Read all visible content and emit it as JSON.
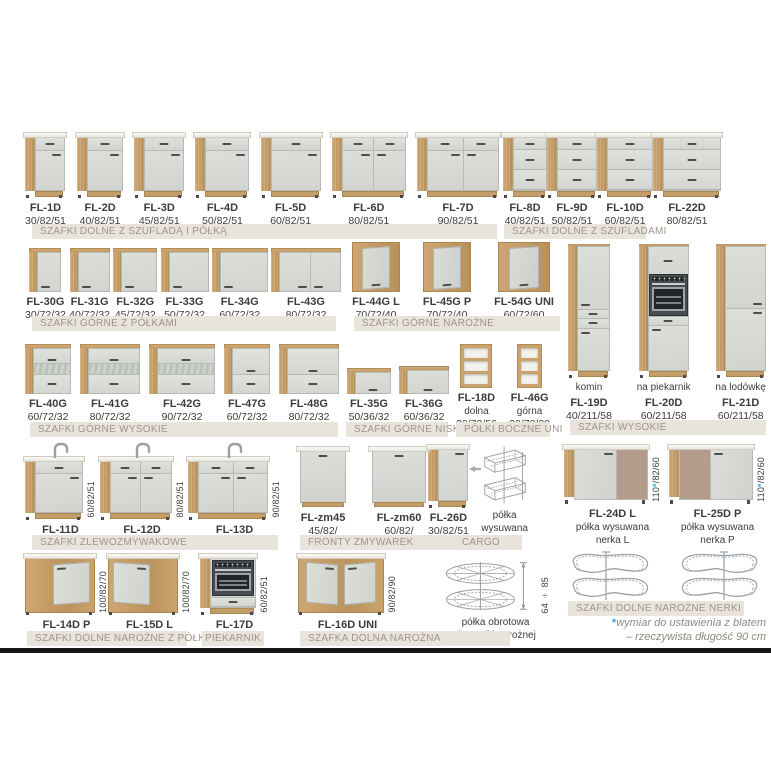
{
  "page": {
    "width": 771,
    "height": 771,
    "background": "#ffffff"
  },
  "colors": {
    "wood": "#c9a26c",
    "front_gray": "#d7d9d5",
    "countertop": "#f5f3ee",
    "bar_bg": "#e8e4dc",
    "bar_text": "#9c968c",
    "text": "#3e3c39",
    "accent_blue": "#29a8df",
    "taupe_panel": "#b49c8d",
    "wire": "#9aa0a5",
    "footnote_text": "#8f8981",
    "divider": "#161616"
  },
  "sections": [
    {
      "id": "dolne-szuflada-polka",
      "x": 25,
      "y": 130,
      "w": 474,
      "art_h": 68,
      "items": [
        {
          "code": "FL-1D",
          "dims": "30/82/51",
          "variant": "dd",
          "w": 40
        },
        {
          "code": "FL-2D",
          "dims": "40/82/51",
          "variant": "dd",
          "w": 46
        },
        {
          "code": "FL-3D",
          "dims": "45/82/51",
          "variant": "dd",
          "w": 50
        },
        {
          "code": "FL-4D",
          "dims": "50/82/51",
          "variant": "dd",
          "w": 54
        },
        {
          "code": "FL-5D",
          "dims": "60/82/51",
          "variant": "dd",
          "w": 60
        },
        {
          "code": "FL-6D",
          "dims": "80/82/51",
          "variant": "dd2",
          "w": 74
        },
        {
          "code": "FL-7D",
          "dims": "90/82/51",
          "variant": "dd2",
          "w": 82
        }
      ]
    },
    {
      "id": "dolne-szufladami",
      "x": 503,
      "y": 130,
      "w": 214,
      "art_h": 68,
      "items": [
        {
          "code": "FL-8D",
          "dims": "40/82/51",
          "variant": "d3",
          "w": 44
        },
        {
          "code": "FL-9D",
          "dims": "50/82/51",
          "variant": "d3",
          "w": 50
        },
        {
          "code": "FL-10D",
          "dims": "60/82/51",
          "variant": "d3",
          "w": 56
        },
        {
          "code": "FL-22D",
          "dims": "80/82/51",
          "variant": "d3",
          "w": 68
        }
      ]
    },
    {
      "id": "gorne-z-polkami",
      "x": 25,
      "y": 244,
      "w": 316,
      "art_h": 48,
      "items": [
        {
          "code": "FL-30G",
          "dims": "30/72/32",
          "variant": "up1",
          "w": 32
        },
        {
          "code": "FL-31G",
          "dims": "40/72/32",
          "variant": "up1",
          "w": 40
        },
        {
          "code": "FL-32G",
          "dims": "45/72/32",
          "variant": "up1",
          "w": 44
        },
        {
          "code": "FL-33G",
          "dims": "50/72/32",
          "variant": "up1",
          "w": 48
        },
        {
          "code": "FL-34G",
          "dims": "60/72/32",
          "variant": "up1",
          "w": 56
        },
        {
          "code": "FL-43G",
          "dims": "80/72/32",
          "variant": "up2",
          "w": 70
        }
      ]
    },
    {
      "id": "gorne-narozne",
      "x": 352,
      "y": 244,
      "w": 202,
      "art_h": 48,
      "items": [
        {
          "code": "FL-44G L",
          "dims": "70/72/40",
          "variant": "ucorner",
          "w": 48
        },
        {
          "code": "FL-45G P",
          "dims": "70/72/40",
          "variant": "ucorner",
          "w": 48
        },
        {
          "code": "FL-54G UNI",
          "dims": "60/72/60",
          "variant": "ucorner",
          "w": 52
        }
      ]
    },
    {
      "id": "wysokie",
      "x": 566,
      "y": 240,
      "w": 200,
      "art_h": 138,
      "items": [
        {
          "pre": "komin",
          "code": "FL-19D",
          "dims": "40/211/58",
          "variant": "tall1",
          "w": 42
        },
        {
          "pre": "na piekarnik",
          "code": "FL-20D",
          "dims": "60/211/58",
          "variant": "tallov",
          "w": 50
        },
        {
          "pre": "na lodówkę",
          "code": "FL-21D",
          "dims": "60/211/58",
          "variant": "tallfr",
          "w": 50
        }
      ]
    },
    {
      "id": "gorne-wysokie",
      "x": 25,
      "y": 342,
      "w": 314,
      "art_h": 52,
      "items": [
        {
          "code": "FL-40G",
          "dims": "60/72/32",
          "variant": "upflipg",
          "w": 46
        },
        {
          "code": "FL-41G",
          "dims": "80/72/32",
          "variant": "upflipg",
          "w": 60
        },
        {
          "code": "FL-42G",
          "dims": "90/72/32",
          "variant": "upflipg",
          "w": 66
        },
        {
          "code": "FL-47G",
          "dims": "60/72/32",
          "variant": "upflip2",
          "w": 46
        },
        {
          "code": "FL-48G",
          "dims": "80/72/32",
          "variant": "upflip2",
          "w": 60
        }
      ]
    },
    {
      "id": "gorne-niskie",
      "x": 347,
      "y": 342,
      "w": 102,
      "art_h": 52,
      "items": [
        {
          "code": "FL-35G",
          "dims": "50/36/32",
          "variant": "uplow",
          "w": 44,
          "h": 26
        },
        {
          "code": "FL-36G",
          "dims": "60/36/32",
          "variant": "uplow",
          "w": 50,
          "h": 28
        }
      ]
    },
    {
      "id": "polki-boczne-uni",
      "x": 456,
      "y": 342,
      "w": 94,
      "art_h": 46,
      "items": [
        {
          "code": "FL-18D",
          "sub": [
            "dolna"
          ],
          "dims": "20/72/56",
          "variant": "shelf",
          "w": 32,
          "h": 44
        },
        {
          "code": "FL-46G",
          "sub": [
            "górna"
          ],
          "dims": "20/72/30",
          "variant": "shelf",
          "w": 25,
          "h": 44
        }
      ]
    },
    {
      "id": "zlewozmywakowe",
      "x": 25,
      "y": 440,
      "w": 256,
      "art_h": 80,
      "items": [
        {
          "code": "FL-11D",
          "vdim": "60/82/51",
          "variant": "sink1",
          "w": 58
        },
        {
          "code": "FL-12D",
          "vdim": "80/82/51",
          "variant": "sink2",
          "w": 72
        },
        {
          "code": "FL-13D",
          "vdim": "90/82/51",
          "variant": "sink2",
          "w": 80
        }
      ]
    },
    {
      "id": "fronty-zmywarek",
      "x": 298,
      "y": 430,
      "w": 130,
      "art_h": 78,
      "items": [
        {
          "code": "FL-zm45",
          "dims": "45/82/",
          "variant": "panel",
          "w": 50
        },
        {
          "code": "FL-zm60",
          "dims": "60/82/",
          "variant": "panel",
          "w": 58
        }
      ]
    },
    {
      "id": "cargo",
      "x": 428,
      "y": 430,
      "w": 100,
      "art_h": 78,
      "items": [
        {
          "code": "FL-26D",
          "dims": "30/82/51",
          "variant": "base1",
          "w": 40
        },
        {
          "variant": "arrow",
          "w": 12,
          "valign": "center"
        },
        {
          "sub": [
            "półka",
            "wysuwana"
          ],
          "variant": "cargoSvg",
          "w": 46,
          "h": 66
        }
      ]
    },
    {
      "id": "narozne-nerki",
      "x": 564,
      "y": 444,
      "w": 202,
      "art_h": 60,
      "items": [
        {
          "code": "FL-24D L",
          "sub": [
            "półka wysuwana",
            "nerka L"
          ],
          "vdim": "110*/82/60",
          "variant": "nerkaL",
          "w": 84
        },
        {
          "code": "FL-25D P",
          "sub": [
            "półka wysuwana",
            "nerka P"
          ],
          "vdim": "110*/82/60",
          "variant": "nerkaR",
          "w": 84
        }
      ],
      "items2": [
        {
          "variant": "nerkaSvgL",
          "w": 88,
          "h": 50
        },
        {
          "variant": "nerkaSvgR",
          "w": 88,
          "h": 50
        }
      ]
    },
    {
      "id": "dolne-narozne-z-polka",
      "x": 25,
      "y": 553,
      "w": 164,
      "art_h": 62,
      "items": [
        {
          "code": "FL-14D P",
          "vdim": "100/82/70",
          "variant": "cornerP",
          "w": 70
        },
        {
          "code": "FL-15D L",
          "vdim": "100/82/70",
          "variant": "cornerL",
          "w": 70
        }
      ]
    },
    {
      "id": "piekarnik",
      "x": 200,
      "y": 553,
      "w": 70,
      "art_h": 62,
      "items": [
        {
          "code": "FL-17D",
          "vdim": "60/82/51",
          "variant": "ovenbase",
          "w": 56
        }
      ]
    },
    {
      "id": "dolna-narozna",
      "x": 298,
      "y": 553,
      "w": 252,
      "art_h": 62,
      "items": [
        {
          "code": "FL-16D UNI",
          "vdim": "90/82/90",
          "variant": "cornerUni",
          "w": 86
        },
        {
          "sub": [
            "półka obrotowa",
            "do szafki narożnej"
          ],
          "vdim": "64 ÷ 85",
          "variant": "rotarySvg",
          "w": 96,
          "h": 58
        }
      ]
    }
  ],
  "bars": [
    {
      "label": "SZAFKI DOLNE Z SZUFLADĄ I PÓŁKĄ",
      "x": 32,
      "y": 224,
      "w": 465
    },
    {
      "label": "SZAFKI DOLNE Z SZUFLADAMI",
      "x": 504,
      "y": 224,
      "w": 142
    },
    {
      "label": "SZAFKI GÓRNE Z PÓŁKAMI",
      "x": 32,
      "y": 316,
      "w": 304
    },
    {
      "label": "SZAFKI GÓRNE NAROŻNE",
      "x": 354,
      "y": 316,
      "w": 206
    },
    {
      "label": "SZAFKI WYSOKIE",
      "x": 570,
      "y": 420,
      "w": 196
    },
    {
      "label": "SZAFKI GÓRNE WYSOKIE",
      "x": 30,
      "y": 422,
      "w": 308
    },
    {
      "label": "SZAFKI GÓRNE NISKIE",
      "x": 346,
      "y": 422,
      "w": 102
    },
    {
      "label": "PÓŁKI BOCZNE UNI",
      "x": 456,
      "y": 422,
      "w": 94
    },
    {
      "label": "SZAFKI ZLEWOZMYWAKOWE",
      "x": 32,
      "y": 535,
      "w": 246
    },
    {
      "label": "FRONTY ZMYWAREK",
      "label2": "CARGO",
      "x": 300,
      "y": 535,
      "w": 222
    },
    {
      "label": "SZAFKI DOLNE NAROŻNE NERKI",
      "x": 568,
      "y": 601,
      "w": 176
    },
    {
      "label": "SZAFKI DOLNE NAROŻNE Z PÓŁKĄ",
      "x": 27,
      "y": 631,
      "w": 160
    },
    {
      "label": "PIEKARNIK",
      "x": 202,
      "y": 631,
      "w": 62,
      "center": true
    },
    {
      "label": "SZAFKA DOLNA NAROŻNA",
      "x": 300,
      "y": 631,
      "w": 210
    }
  ],
  "footnote": {
    "star": "*",
    "line1": "wymiar do ustawienia z blatem",
    "line2": "– rzeczywista długość 90 cm"
  }
}
